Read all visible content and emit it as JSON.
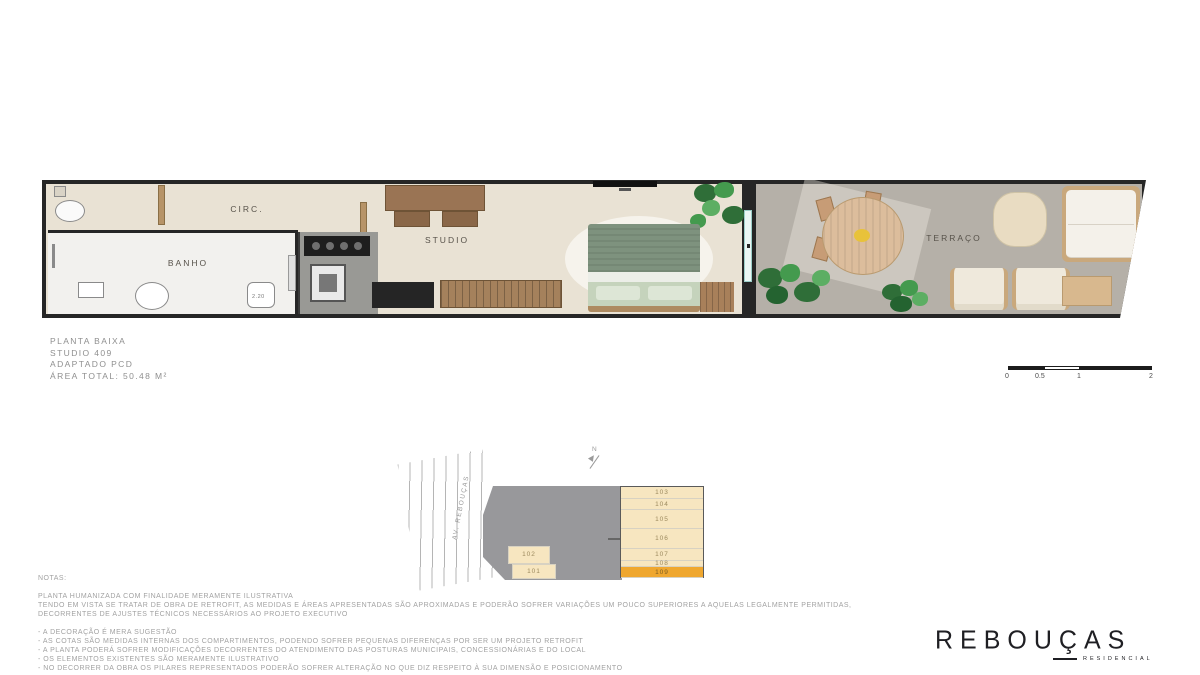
{
  "plan": {
    "rooms": {
      "circ": "CIRC.",
      "banho": "BANHO",
      "studio": "STUDIO",
      "terraco": "TERRAÇO"
    },
    "dimensions": {
      "banho_width": "2.20"
    }
  },
  "title_block": {
    "line1": "PLANTA BAIXA",
    "line2": "STUDIO 409",
    "line3": "ADAPTADO PCD",
    "line4": "ÁREA TOTAL: 50.48 M²"
  },
  "scale_bar": {
    "labels": [
      "0",
      "0.5",
      "1",
      "2"
    ]
  },
  "key_plan": {
    "street_label": "AV. REBOUÇAS",
    "north_label": "N",
    "units": [
      "103",
      "104",
      "105",
      "106",
      "107",
      "108"
    ],
    "highlighted_unit": "109",
    "lower_units": [
      "102",
      "101"
    ]
  },
  "notes": {
    "heading": "NOTAS:",
    "paragraph": [
      "PLANTA HUMANIZADA COM FINALIDADE MERAMENTE ILUSTRATIVA",
      "TENDO EM VISTA SE TRATAR DE OBRA DE RETROFIT, AS MEDIDAS E ÁREAS APRESENTADAS SÃO APROXIMADAS E PODERÃO SOFRER VARIAÇÕES UM POUCO SUPERIORES A AQUELAS LEGALMENTE PERMITIDAS,",
      "DECORRENTES DE AJUSTES TÉCNICOS NECESSÁRIOS AO PROJETO EXECUTIVO"
    ],
    "bullets": [
      "- A DECORAÇÃO É MERA SUGESTÃO",
      "- AS COTAS SÃO MEDIDAS INTERNAS DOS COMPARTIMENTOS, PODENDO SOFRER PEQUENAS DIFERENÇAS POR SER UM PROJETO RETROFIT",
      "- A PLANTA PODERÁ SOFRER MODIFICAÇÕES DECORRENTES DO ATENDIMENTO DAS POSTURAS MUNICIPAIS, CONCESSIONÁRIAS E DO LOCAL",
      "- OS ELEMENTOS EXISTENTES SÃO MERAMENTE ILUSTRATIVO",
      "- NO DECORRER DA OBRA OS PILARES REPRESENTADOS PODERÃO SOFRER ALTERAÇÃO NO QUE DIZ RESPEITO À SUA DIMENSÃO E POSICIONAMENTO"
    ]
  },
  "logo": {
    "name": "REBOUÇAS",
    "subtitle": "RESIDENCIAL"
  },
  "colors": {
    "wall": "#262626",
    "interior_floor": "#E9E2D4",
    "bathroom_floor": "#F2F1EE",
    "terrace_floor": "#B5B0A8",
    "kitchen_gray": "#999995",
    "bed_green_dark": "#7E927E",
    "bed_green_light": "#C5D3BC",
    "wood": "#A5815C",
    "plant_green": "#3F8A49",
    "unit_cell_cream": "#F7E6C0",
    "unit_highlight_orange": "#EFA72F",
    "logo_dark": "#1F1F23",
    "text_gray": "#9B9B9B"
  }
}
